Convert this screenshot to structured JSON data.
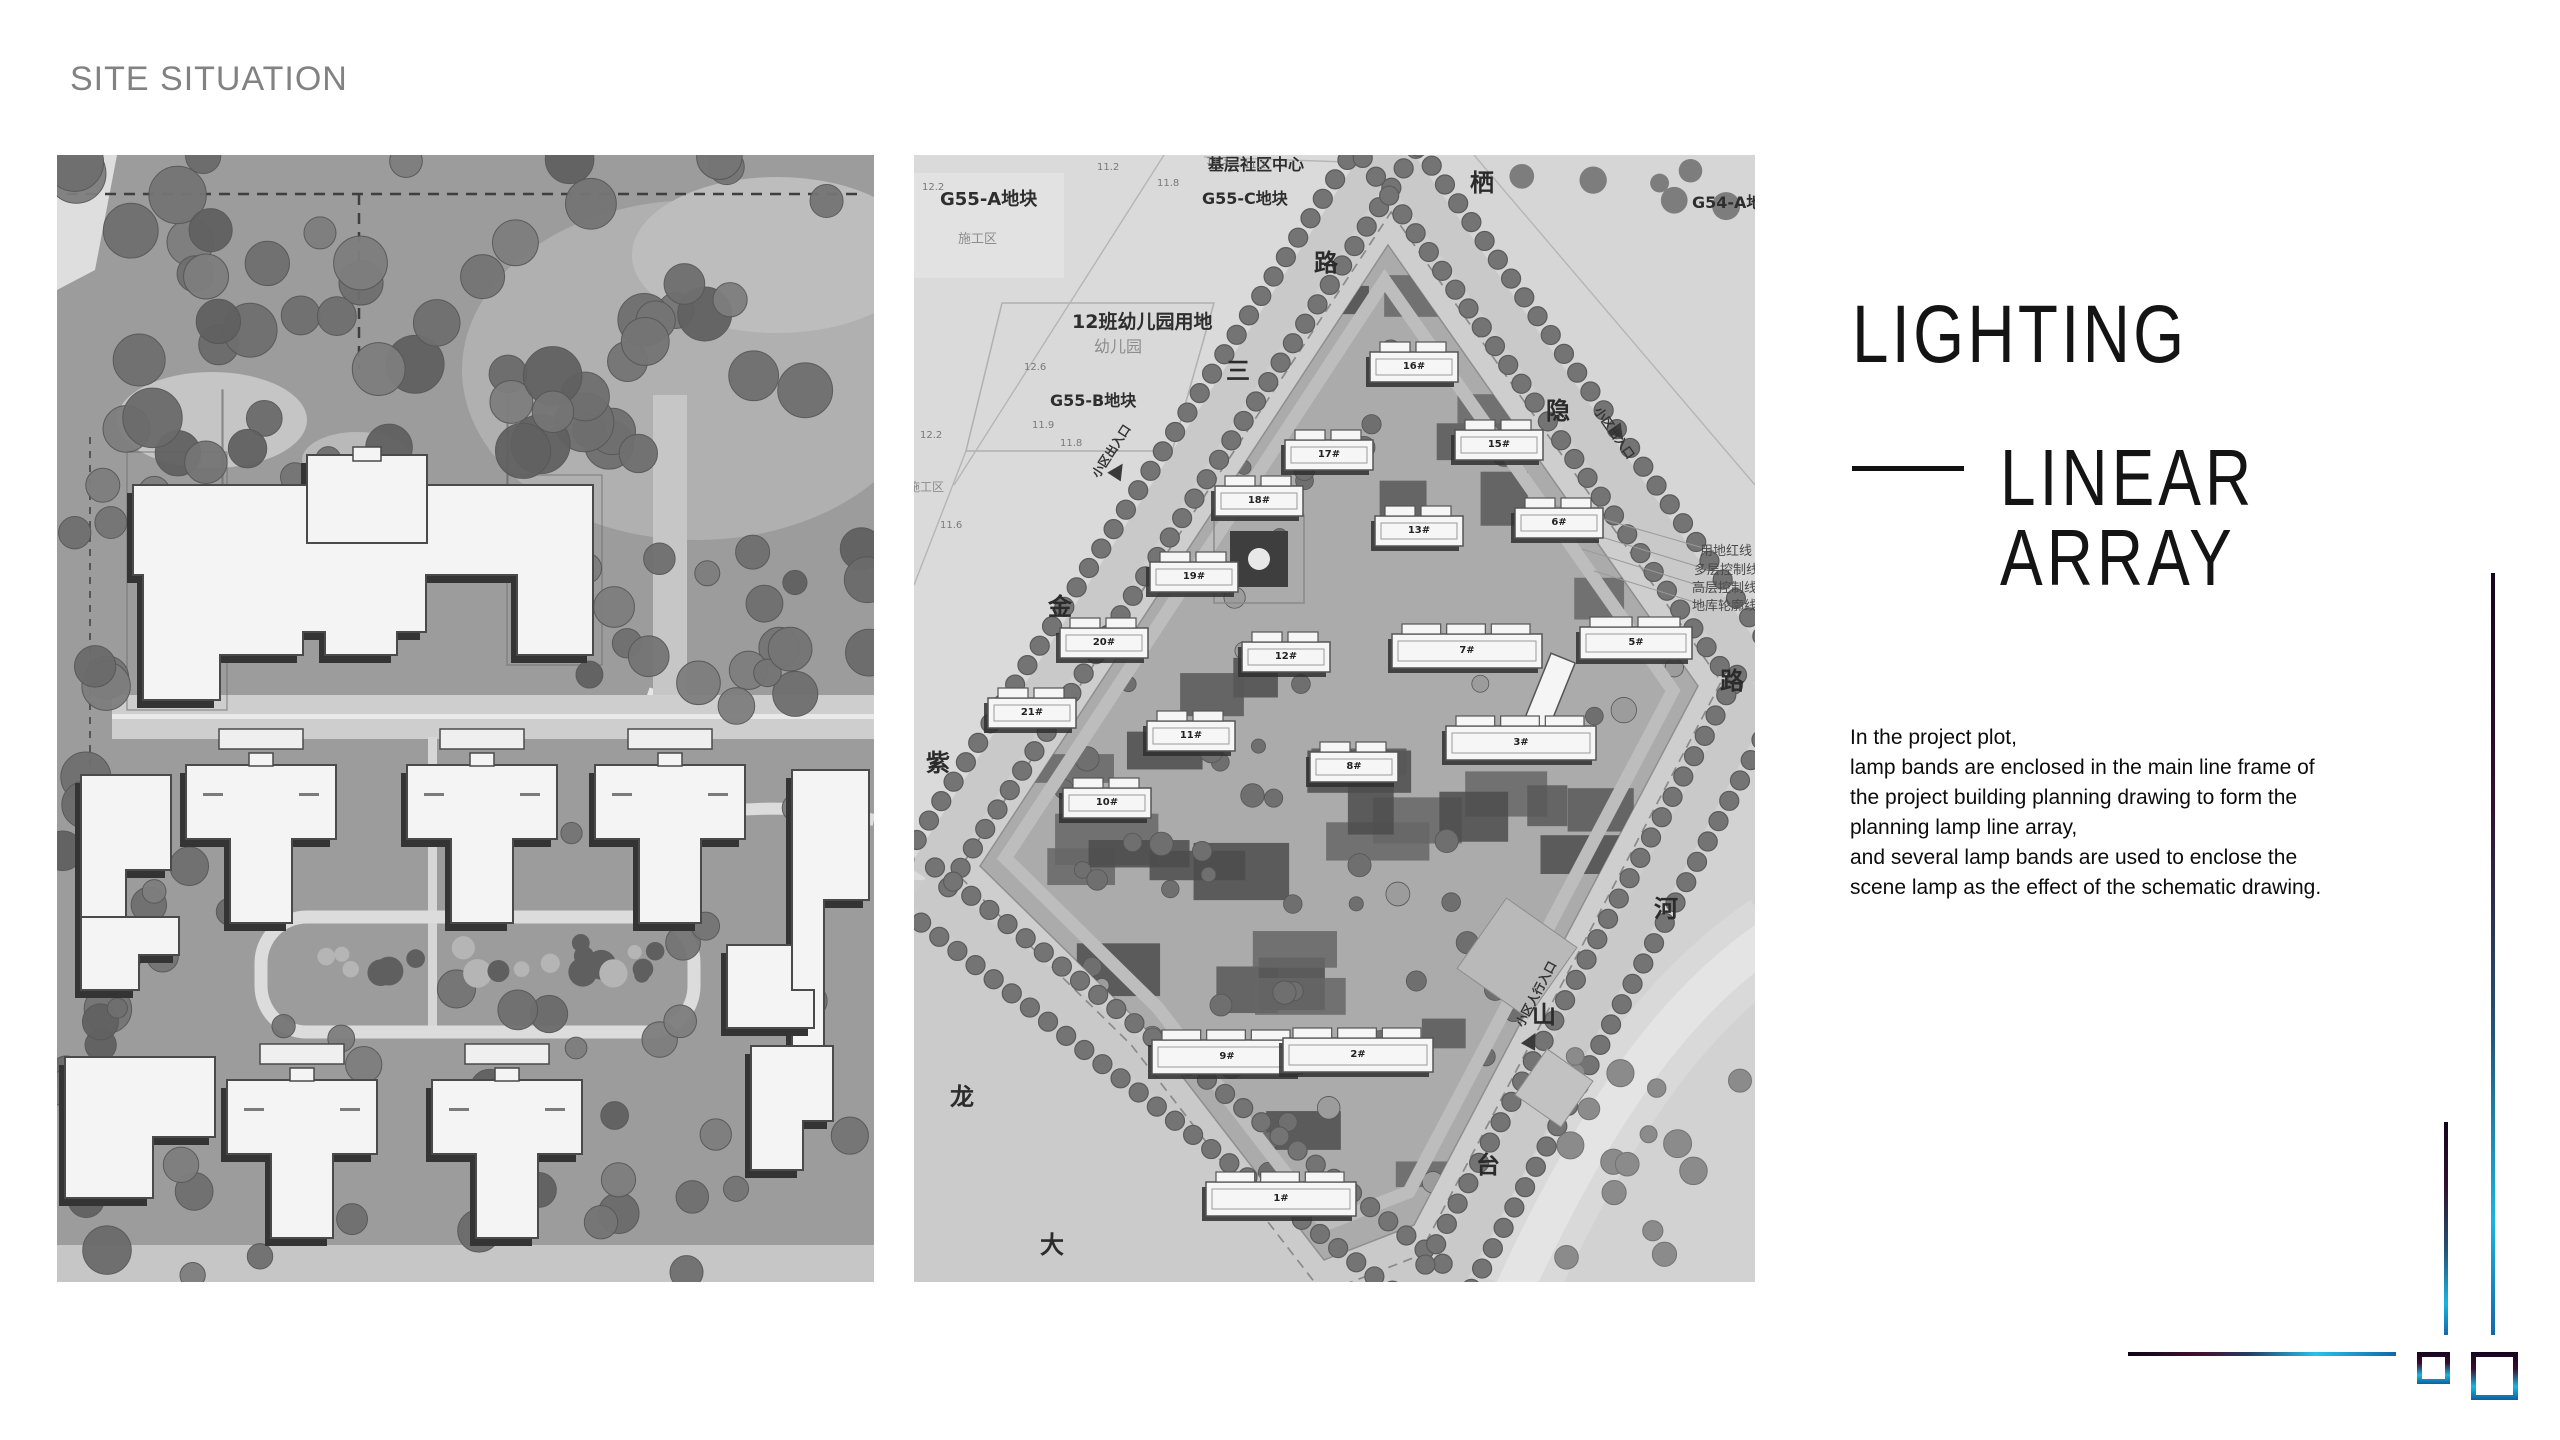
{
  "slide": {
    "eyebrow": "SITE SITUATION"
  },
  "panel": {
    "title": "LIGHTING",
    "subtitle": "LINEAR ARRAY",
    "body_lines": [
      "In the project plot,",
      "lamp bands are enclosed in the main line frame of",
      "the project building planning drawing to form the",
      "planning lamp line array,",
      "and several lamp bands are used to enclose the",
      "scene lamp as the effect of the schematic drawing."
    ]
  },
  "left_map": {
    "alt": "grayscale residential site plan with trees and building footprints"
  },
  "right_map": {
    "alt": "grayscale master plan of diamond-shaped parcel with numbered buildings",
    "parcel_labels": [
      {
        "text": "基层社区中心",
        "x": 294,
        "y": 2,
        "size": 16,
        "cls": ""
      },
      {
        "text": "G55-A地块",
        "x": 26,
        "y": 36,
        "size": 18,
        "cls": ""
      },
      {
        "text": "施工区",
        "x": 44,
        "y": 78,
        "size": 13,
        "cls": "light"
      },
      {
        "text": "G55-C地块",
        "x": 288,
        "y": 36,
        "size": 16,
        "cls": ""
      },
      {
        "text": "G54-A地",
        "x": 778,
        "y": 40,
        "size": 16,
        "cls": ""
      },
      {
        "text": "12班幼儿园用地",
        "x": 158,
        "y": 158,
        "size": 19,
        "cls": ""
      },
      {
        "text": "幼儿园",
        "x": 180,
        "y": 184,
        "size": 16,
        "cls": "light"
      },
      {
        "text": "G55-B地块",
        "x": 136,
        "y": 238,
        "size": 16,
        "cls": ""
      },
      {
        "text": "施工区",
        "x": -6,
        "y": 326,
        "size": 12,
        "cls": "light"
      }
    ],
    "road_labels": [
      {
        "text": "栖",
        "x": 556,
        "y": 16
      },
      {
        "text": "路",
        "x": 400,
        "y": 96
      },
      {
        "text": "三",
        "x": 312,
        "y": 204
      },
      {
        "text": "金",
        "x": 134,
        "y": 440
      },
      {
        "text": "紫",
        "x": 12,
        "y": 596
      },
      {
        "text": "龙",
        "x": 36,
        "y": 930
      },
      {
        "text": "大",
        "x": 126,
        "y": 1078
      },
      {
        "text": "隐",
        "x": 632,
        "y": 244
      },
      {
        "text": "路",
        "x": 806,
        "y": 514
      },
      {
        "text": "河",
        "x": 740,
        "y": 742
      },
      {
        "text": "山",
        "x": 618,
        "y": 848
      },
      {
        "text": "台",
        "x": 562,
        "y": 998
      }
    ],
    "building_labels": [
      {
        "text": "16#",
        "x": 500,
        "y": 212
      },
      {
        "text": "17#",
        "x": 415,
        "y": 300
      },
      {
        "text": "15#",
        "x": 585,
        "y": 290
      },
      {
        "text": "18#",
        "x": 345,
        "y": 346
      },
      {
        "text": "6#",
        "x": 645,
        "y": 368
      },
      {
        "text": "13#",
        "x": 505,
        "y": 376
      },
      {
        "text": "19#",
        "x": 280,
        "y": 422
      },
      {
        "text": "20#",
        "x": 190,
        "y": 488
      },
      {
        "text": "12#",
        "x": 372,
        "y": 502
      },
      {
        "text": "7#",
        "x": 553,
        "y": 496
      },
      {
        "text": "5#",
        "x": 722,
        "y": 488
      },
      {
        "text": "21#",
        "x": 118,
        "y": 558
      },
      {
        "text": "11#",
        "x": 277,
        "y": 581
      },
      {
        "text": "3#",
        "x": 607,
        "y": 588
      },
      {
        "text": "8#",
        "x": 440,
        "y": 612
      },
      {
        "text": "10#",
        "x": 193,
        "y": 648
      },
      {
        "text": "9#",
        "x": 313,
        "y": 902
      },
      {
        "text": "2#",
        "x": 444,
        "y": 900
      },
      {
        "text": "1#",
        "x": 367,
        "y": 1044
      }
    ],
    "entrance_labels": [
      {
        "text": "小区出入口",
        "x": 176,
        "y": 318,
        "rot": -57
      },
      {
        "text": "小区出入口",
        "x": 688,
        "y": 250,
        "rot": 55
      },
      {
        "text": "小区人行入口",
        "x": 600,
        "y": 868,
        "rot": -62
      }
    ],
    "elevation_labels": [
      {
        "text": "11.3",
        "x": 292,
        "y": 2
      },
      {
        "text": "11.2",
        "x": 330,
        "y": 6
      },
      {
        "text": "11.2",
        "x": 183,
        "y": 8
      },
      {
        "text": "11.8",
        "x": 243,
        "y": 24
      },
      {
        "text": "12.2",
        "x": 8,
        "y": 28
      },
      {
        "text": "12.6",
        "x": 110,
        "y": 208
      },
      {
        "text": "11.9",
        "x": 118,
        "y": 266
      },
      {
        "text": "11.8",
        "x": 146,
        "y": 284
      },
      {
        "text": "12.2",
        "x": 6,
        "y": 276
      },
      {
        "text": "11.6",
        "x": 26,
        "y": 366
      }
    ],
    "annotation_labels": [
      {
        "text": "用地红线",
        "x": 786,
        "y": 390
      },
      {
        "text": "多层控制线",
        "x": 780,
        "y": 409
      },
      {
        "text": "高层控制线",
        "x": 778,
        "y": 427
      },
      {
        "text": "地库轮廓线",
        "x": 778,
        "y": 445
      }
    ]
  },
  "decor_colors": {
    "gradient_dark": "#15051e",
    "gradient_maroon": "#3c0c2e",
    "gradient_cyan": "#1ab4e2",
    "gradient_blue": "#1368a8"
  }
}
